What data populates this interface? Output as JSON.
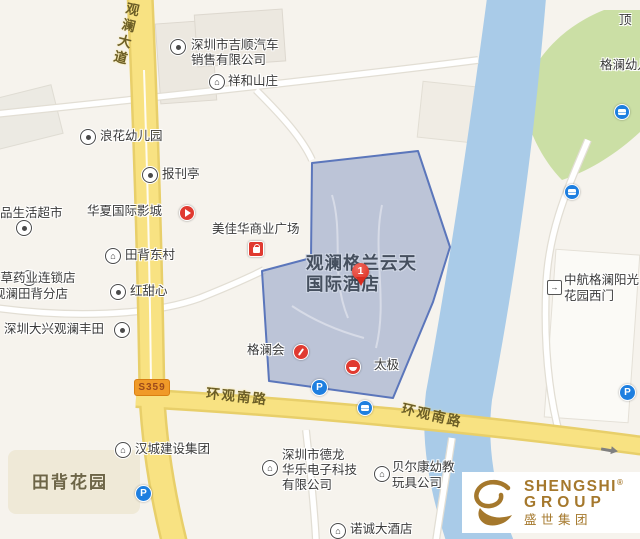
{
  "map": {
    "highlight": {
      "name_line1": "观澜格兰云天",
      "name_line2": "国际酒店",
      "marker_number": "1"
    },
    "roads": {
      "guanlan_avenue": "观澜大道",
      "huanguan_south_road_west": "环观南路",
      "huanguan_south_road_east": "环观南路",
      "s359_badge": "S359"
    },
    "areas": {
      "tianbei_garden": "田背花园",
      "top_right_partial": "顶",
      "gelan_kindergarten": "格澜幼儿园"
    },
    "pois": {
      "jishun_auto_l1": "深圳市吉顺汽车",
      "jishun_auto_l2": "销售有限公司",
      "xianghe_villa": "祥和山庄",
      "langhua_kindergarten": "浪花幼儿园",
      "newsstand": "报刊亭",
      "life_supermarket": "品生活超市",
      "huaxia_cinema": "华夏国际影城",
      "meijiahua_plaza": "美佳华商业广场",
      "tianbei_east_village": "田背东村",
      "herb_pharmacy_l1": "本草药业连锁店",
      "herb_pharmacy_l2": "观澜田背分店",
      "hongtianxin": "红甜心",
      "daxing_toyota": "深圳大兴观澜丰田",
      "gelanhui": "格澜会",
      "taiji": "太极",
      "zhonghang_gate_l1": "中航格澜阳光",
      "zhonghang_gate_l2": "花园西门",
      "hancheng_group": "汉城建设集团",
      "delong_l1": "深圳市德龙",
      "delong_l2": "华乐电子科技",
      "delong_l3": "有限公司",
      "beierkang_l1": "贝尔康幼教",
      "beierkang_l2": "玩具公司",
      "nuocheng_hotel": "诺诚大酒店"
    },
    "icons": {
      "building_glyph": "⌂",
      "parking_letter": "P"
    }
  },
  "watermark": {
    "brand_line1": "SHENGSHI",
    "registered": "®",
    "brand_line2": "GROUP",
    "brand_cn": "盛世集团"
  },
  "colors": {
    "road_yellow": "#f8e282",
    "river_blue": "#a9cbe8",
    "park_green": "#cbdfa5",
    "highlight_fill": "#8d9dc4",
    "highlight_border": "#5b76bb",
    "marker_red": "#d92b1f",
    "poi_red": "#e03a30",
    "transit_blue": "#1e7fe0",
    "brand_gold": "#a5782c"
  }
}
